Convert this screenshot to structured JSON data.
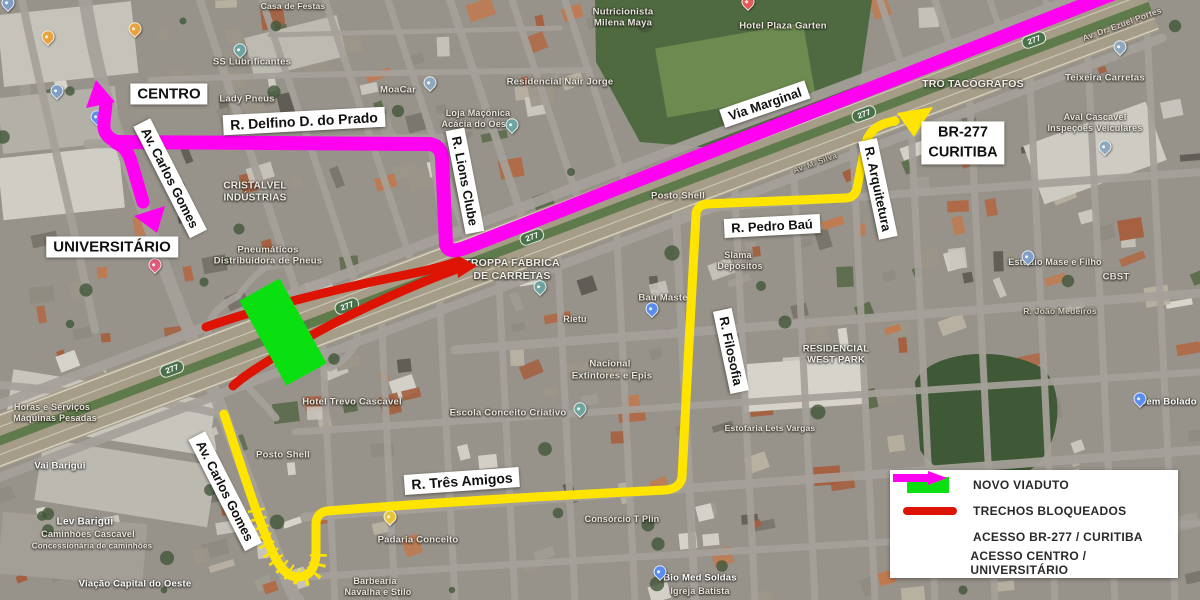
{
  "colors": {
    "novo_viaduto": "#0ae010",
    "trechos_bloqueados": "#dd1404",
    "acesso_br277": "#ffe400",
    "acesso_centro": "#ff00f0",
    "label_bg": "#ffffff",
    "label_text": "#111111",
    "shield_green": "#49724a"
  },
  "street_labels": {
    "centro": "CENTRO",
    "delfino": "R. Delfino D. do Prado",
    "carlos_gomes_upper": "Av. Carlos Gomes",
    "universitario": "UNIVERSITÁRIO",
    "lions_clube": "R. Lions Clube",
    "via_marginal": "Via Marginal",
    "br277_line1": "BR-277",
    "br277_line2": "CURITIBA",
    "pedro_bau": "R. Pedro Baú",
    "arquitetura": "R. Arquitetura",
    "filosofia": "R. Filosofia",
    "tres_amigos": "R. Três Amigos",
    "carlos_gomes_lower": "Av. Carlos Gomes"
  },
  "legend": {
    "items": [
      {
        "label": "NOVO VIADUTO",
        "swatch": "rect"
      },
      {
        "label": "TRECHOS BLOQUEADOS",
        "swatch": "line"
      },
      {
        "label": "ACESSO BR-277 / CURITIBA",
        "swatch": "arrow"
      },
      {
        "label": "ACESSO CENTRO / UNIVERSITÁRIO",
        "swatch": "arrow"
      }
    ]
  },
  "poi_labels": [
    {
      "t": "Casa de Festas",
      "x": 293,
      "y": 6,
      "s": 8.5
    },
    {
      "t": "Nutricionista",
      "x": 623,
      "y": 12
    },
    {
      "t": "Milena Maya",
      "x": 623,
      "y": 23
    },
    {
      "t": "Hotel Plaza Garten",
      "x": 783,
      "y": 26
    },
    {
      "t": "Av. Dr. Ezuel Portes",
      "x": 1122,
      "y": 24,
      "r": -20,
      "s": 8.5,
      "c": "#ddd8c8"
    },
    {
      "t": "SS Lubrificantes",
      "x": 252,
      "y": 62
    },
    {
      "t": "Residencial Nair Jorge",
      "x": 560,
      "y": 82
    },
    {
      "t": "TRO TACÓGRAFOS",
      "x": 973,
      "y": 84,
      "s": 10.5,
      "c": "#f2efe6"
    },
    {
      "t": "Teixeira Carretas",
      "x": 1105,
      "y": 78
    },
    {
      "t": "MoaCar",
      "x": 398,
      "y": 90
    },
    {
      "t": "Lady Pneus",
      "x": 247,
      "y": 99
    },
    {
      "t": "Loja Maçônica",
      "x": 478,
      "y": 113,
      "s": 9
    },
    {
      "t": "Acácia do Oeste",
      "x": 478,
      "y": 124,
      "s": 9
    },
    {
      "t": "Aval Cascavel",
      "x": 1095,
      "y": 117,
      "s": 9
    },
    {
      "t": "Inspeções Veiculares",
      "x": 1095,
      "y": 128,
      "s": 9
    },
    {
      "t": "Av. M. Silva",
      "x": 815,
      "y": 163,
      "r": -20,
      "s": 8,
      "c": "#cfc9b5"
    },
    {
      "t": "CRISTALVEL",
      "x": 255,
      "y": 186,
      "s": 10,
      "c": "#f0ede4"
    },
    {
      "t": "INDÚSTRIAS",
      "x": 255,
      "y": 198,
      "s": 10,
      "c": "#f0ede4"
    },
    {
      "t": "Posto Shell",
      "x": 678,
      "y": 196
    },
    {
      "t": "Pneumáticos",
      "x": 268,
      "y": 250
    },
    {
      "t": "Distribuidora de Pneus",
      "x": 268,
      "y": 261
    },
    {
      "t": "TROPPA FÁBRICA",
      "x": 512,
      "y": 263,
      "s": 10.5,
      "c": "#f2efe6"
    },
    {
      "t": "DE CARRETAS",
      "x": 512,
      "y": 276,
      "s": 10.5,
      "c": "#f2efe6"
    },
    {
      "t": "Slama",
      "x": 738,
      "y": 255,
      "s": 9
    },
    {
      "t": "Depósitos",
      "x": 740,
      "y": 266,
      "s": 9
    },
    {
      "t": "Baú Master",
      "x": 665,
      "y": 298
    },
    {
      "t": "Rietu",
      "x": 575,
      "y": 319,
      "s": 9
    },
    {
      "t": "Estúdio Mase e Filho",
      "x": 1055,
      "y": 262,
      "s": 9
    },
    {
      "t": "CBST",
      "x": 1116,
      "y": 277,
      "s": 9.5
    },
    {
      "t": "R. João Medeiros",
      "x": 1060,
      "y": 311,
      "s": 8.5,
      "c": "#d8d3c4"
    },
    {
      "t": "RESIDENCIAL",
      "x": 836,
      "y": 349,
      "s": 9.5,
      "c": "#f0ede4"
    },
    {
      "t": "WEST PARK",
      "x": 836,
      "y": 360,
      "s": 9.5,
      "c": "#f0ede4"
    },
    {
      "t": "Nacional",
      "x": 610,
      "y": 364
    },
    {
      "t": "Extintores e Epis",
      "x": 612,
      "y": 376
    },
    {
      "t": "Bem Bolado",
      "x": 1168,
      "y": 402,
      "s": 9.5,
      "c": "#ffffff"
    },
    {
      "t": "Hotel Trevo Cascavel",
      "x": 352,
      "y": 402
    },
    {
      "t": "Escola Conceito Criativo",
      "x": 508,
      "y": 413
    },
    {
      "t": "Estofaria Lets Vargas",
      "x": 770,
      "y": 428,
      "s": 8.5
    },
    {
      "t": "Horas e Serviços",
      "x": 52,
      "y": 407,
      "s": 9
    },
    {
      "t": "Máquinas Pesadas",
      "x": 55,
      "y": 418,
      "s": 9
    },
    {
      "t": "Posto Shell",
      "x": 283,
      "y": 455
    },
    {
      "t": "Vai Barigui",
      "x": 60,
      "y": 466,
      "s": 9.5,
      "c": "#ffffff"
    },
    {
      "t": "Consórcio T Plin",
      "x": 622,
      "y": 519,
      "s": 9
    },
    {
      "t": "Lev Barigui",
      "x": 85,
      "y": 522,
      "s": 10,
      "c": "#ffffff"
    },
    {
      "t": "Caminhões Cascavel",
      "x": 88,
      "y": 534,
      "s": 9
    },
    {
      "t": "Concessionária de caminhões",
      "x": 92,
      "y": 546,
      "s": 8
    },
    {
      "t": "Padaria Conceito",
      "x": 418,
      "y": 540
    },
    {
      "t": "Bio Med Soldas",
      "x": 700,
      "y": 578,
      "c": "#ffffff"
    },
    {
      "t": "Barbearia",
      "x": 375,
      "y": 581,
      "s": 9
    },
    {
      "t": "Navalha e Stilo",
      "x": 378,
      "y": 592,
      "s": 9
    },
    {
      "t": "Viação Capital do Oeste",
      "x": 135,
      "y": 584,
      "s": 9.5,
      "c": "#ffffff"
    },
    {
      "t": "Igreja Batista",
      "x": 700,
      "y": 591,
      "s": 9
    }
  ],
  "shields": [
    {
      "t": "277",
      "x": 172,
      "y": 369,
      "r": -20
    },
    {
      "t": "277",
      "x": 347,
      "y": 306,
      "r": -20
    },
    {
      "t": "277",
      "x": 532,
      "y": 237,
      "r": -20
    },
    {
      "t": "277",
      "x": 864,
      "y": 114,
      "r": -20
    },
    {
      "t": "277",
      "x": 1034,
      "y": 40,
      "r": -20
    }
  ],
  "pins": [
    {
      "x": 8,
      "y": 8,
      "c": "#7f9fc6"
    },
    {
      "x": 48,
      "y": 42,
      "c": "#e8a33d"
    },
    {
      "x": 135,
      "y": 34,
      "c": "#e8a33d"
    },
    {
      "x": 57,
      "y": 96,
      "c": "#7f9fc6"
    },
    {
      "x": 97,
      "y": 122,
      "c": "#5b8def"
    },
    {
      "x": 240,
      "y": 55,
      "c": "#6fa3a0"
    },
    {
      "x": 370,
      "y": 122,
      "c": "#8fa8bd"
    },
    {
      "x": 430,
      "y": 88,
      "c": "#8fa8bd"
    },
    {
      "x": 512,
      "y": 130,
      "c": "#6fa3a0"
    },
    {
      "x": 748,
      "y": 7,
      "c": "#e05a5a"
    },
    {
      "x": 1120,
      "y": 52,
      "c": "#8fa8bd"
    },
    {
      "x": 1105,
      "y": 152,
      "c": "#8fa8bd"
    },
    {
      "x": 155,
      "y": 270,
      "c": "#e05a78"
    },
    {
      "x": 540,
      "y": 292,
      "c": "#6fa3a0"
    },
    {
      "x": 652,
      "y": 314,
      "c": "#5b8def"
    },
    {
      "x": 1028,
      "y": 262,
      "c": "#7f9fc6"
    },
    {
      "x": 580,
      "y": 414,
      "c": "#6fa3a0"
    },
    {
      "x": 390,
      "y": 522,
      "c": "#e8c43d"
    },
    {
      "x": 660,
      "y": 577,
      "c": "#5b8def"
    },
    {
      "x": 1140,
      "y": 404,
      "c": "#5b8def"
    }
  ]
}
